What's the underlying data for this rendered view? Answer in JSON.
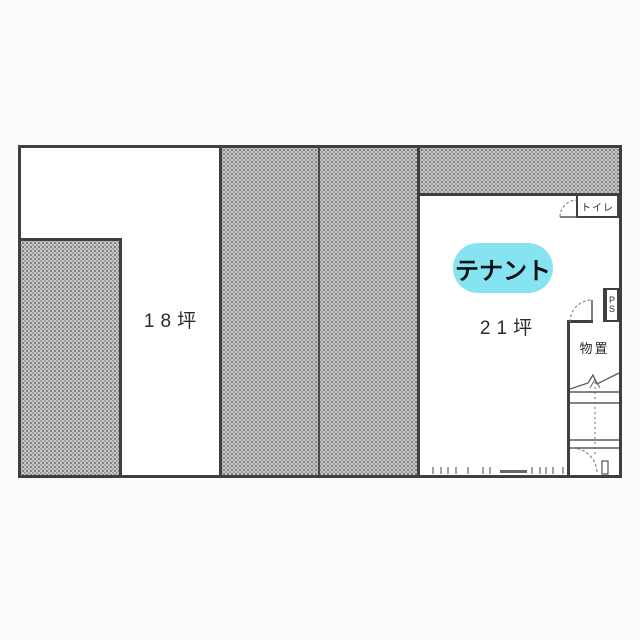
{
  "plan": {
    "title": "tenant-floor-plan",
    "room_left": {
      "area_label": "18坪"
    },
    "tenant_room": {
      "area_label": "21坪",
      "badge_label": "テナント",
      "badge_color": "#86e3f2"
    },
    "toilet": {
      "label": "トイレ"
    },
    "pipe_shaft": {
      "line1": "P",
      "line2": "S"
    },
    "storage": {
      "label": "物置"
    },
    "colors": {
      "wall": "#3f3f3f",
      "halftone": "#bdbdbd",
      "paper": "#fcfcfc"
    }
  }
}
